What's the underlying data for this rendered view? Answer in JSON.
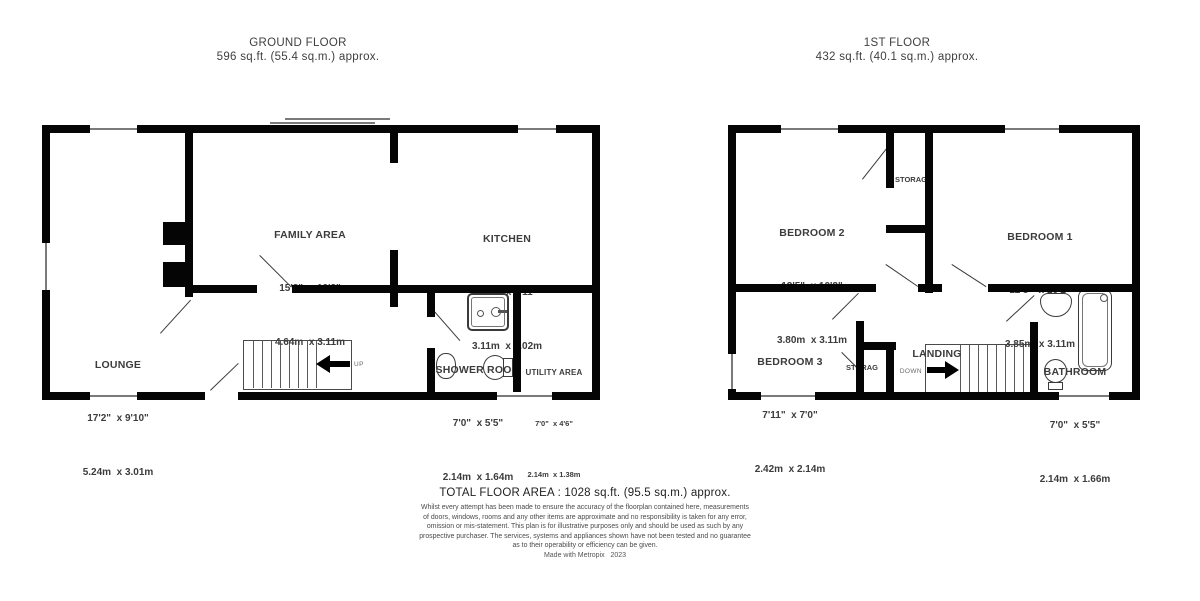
{
  "colors": {
    "wall": "#050505",
    "room_text": "#3c3c3c",
    "title_text": "#3f3f3f",
    "footer_text": "#1f1f1f",
    "disclaimer_text": "#4a4a4a"
  },
  "ground_floor": {
    "title": "GROUND FLOOR",
    "area": "596 sq.ft. (55.4 sq.m.) approx.",
    "rooms": [
      {
        "name": "FAMILY AREA",
        "dims_imperial": "15'3\"  x 10'2\"",
        "dims_metric": "4.64m  x 3.11m"
      },
      {
        "name": "KITCHEN",
        "dims_imperial": "10'2\"  x 9'11\"",
        "dims_metric": "3.11m  x 3.02m"
      },
      {
        "name": "LOUNGE",
        "dims_imperial": "17'2\"  x 9'10\"",
        "dims_metric": "5.24m  x 3.01m"
      },
      {
        "name": "SHOWER ROOM",
        "dims_imperial": "7'0\"  x 5'5\"",
        "dims_metric": "2.14m  x 1.64m"
      },
      {
        "name": "UTILITY AREA",
        "dims_imperial": "7'0\"  x 4'6\"",
        "dims_metric": "2.14m  x 1.38m"
      }
    ],
    "stair_label": "UP"
  },
  "first_floor": {
    "title": "1ST FLOOR",
    "area": "432 sq.ft. (40.1 sq.m.) approx.",
    "rooms": [
      {
        "name": "BEDROOM 2",
        "dims_imperial": "12'5\"  x 10'2\"",
        "dims_metric": "3.80m  x 3.11m"
      },
      {
        "name": "BEDROOM 1",
        "dims_imperial": "12'8\"  x 10'2\"",
        "dims_metric": "3.85m  x 3.11m"
      },
      {
        "name": "BEDROOM 3",
        "dims_imperial": "7'11\"  x 7'0\"",
        "dims_metric": "2.42m  x 2.14m"
      },
      {
        "name": "BATHROOM",
        "dims_imperial": "7'0\"  x 5'5\"",
        "dims_metric": "2.14m  x 1.66m"
      },
      {
        "name": "LANDING"
      }
    ],
    "storage_label": "STORAG",
    "storage_label_2": "STORAG",
    "stair_label": "DOWN"
  },
  "footer": {
    "total_area": "TOTAL FLOOR AREA : 1028 sq.ft. (95.5 sq.m.) approx.",
    "disclaimer_lines": [
      "Whilst every attempt has been made to ensure the accuracy of the floorplan contained here, measurements",
      "of doors, windows, rooms and any other items are approximate and no responsibility is taken for any error,",
      "omission or mis-statement. This plan is for illustrative purposes only and should be used as such by any",
      "prospective purchaser. The services, systems and appliances shown have not been tested and no guarantee",
      "as to their operability or efficiency can be given.",
      "Made with Metropix   2023"
    ]
  }
}
